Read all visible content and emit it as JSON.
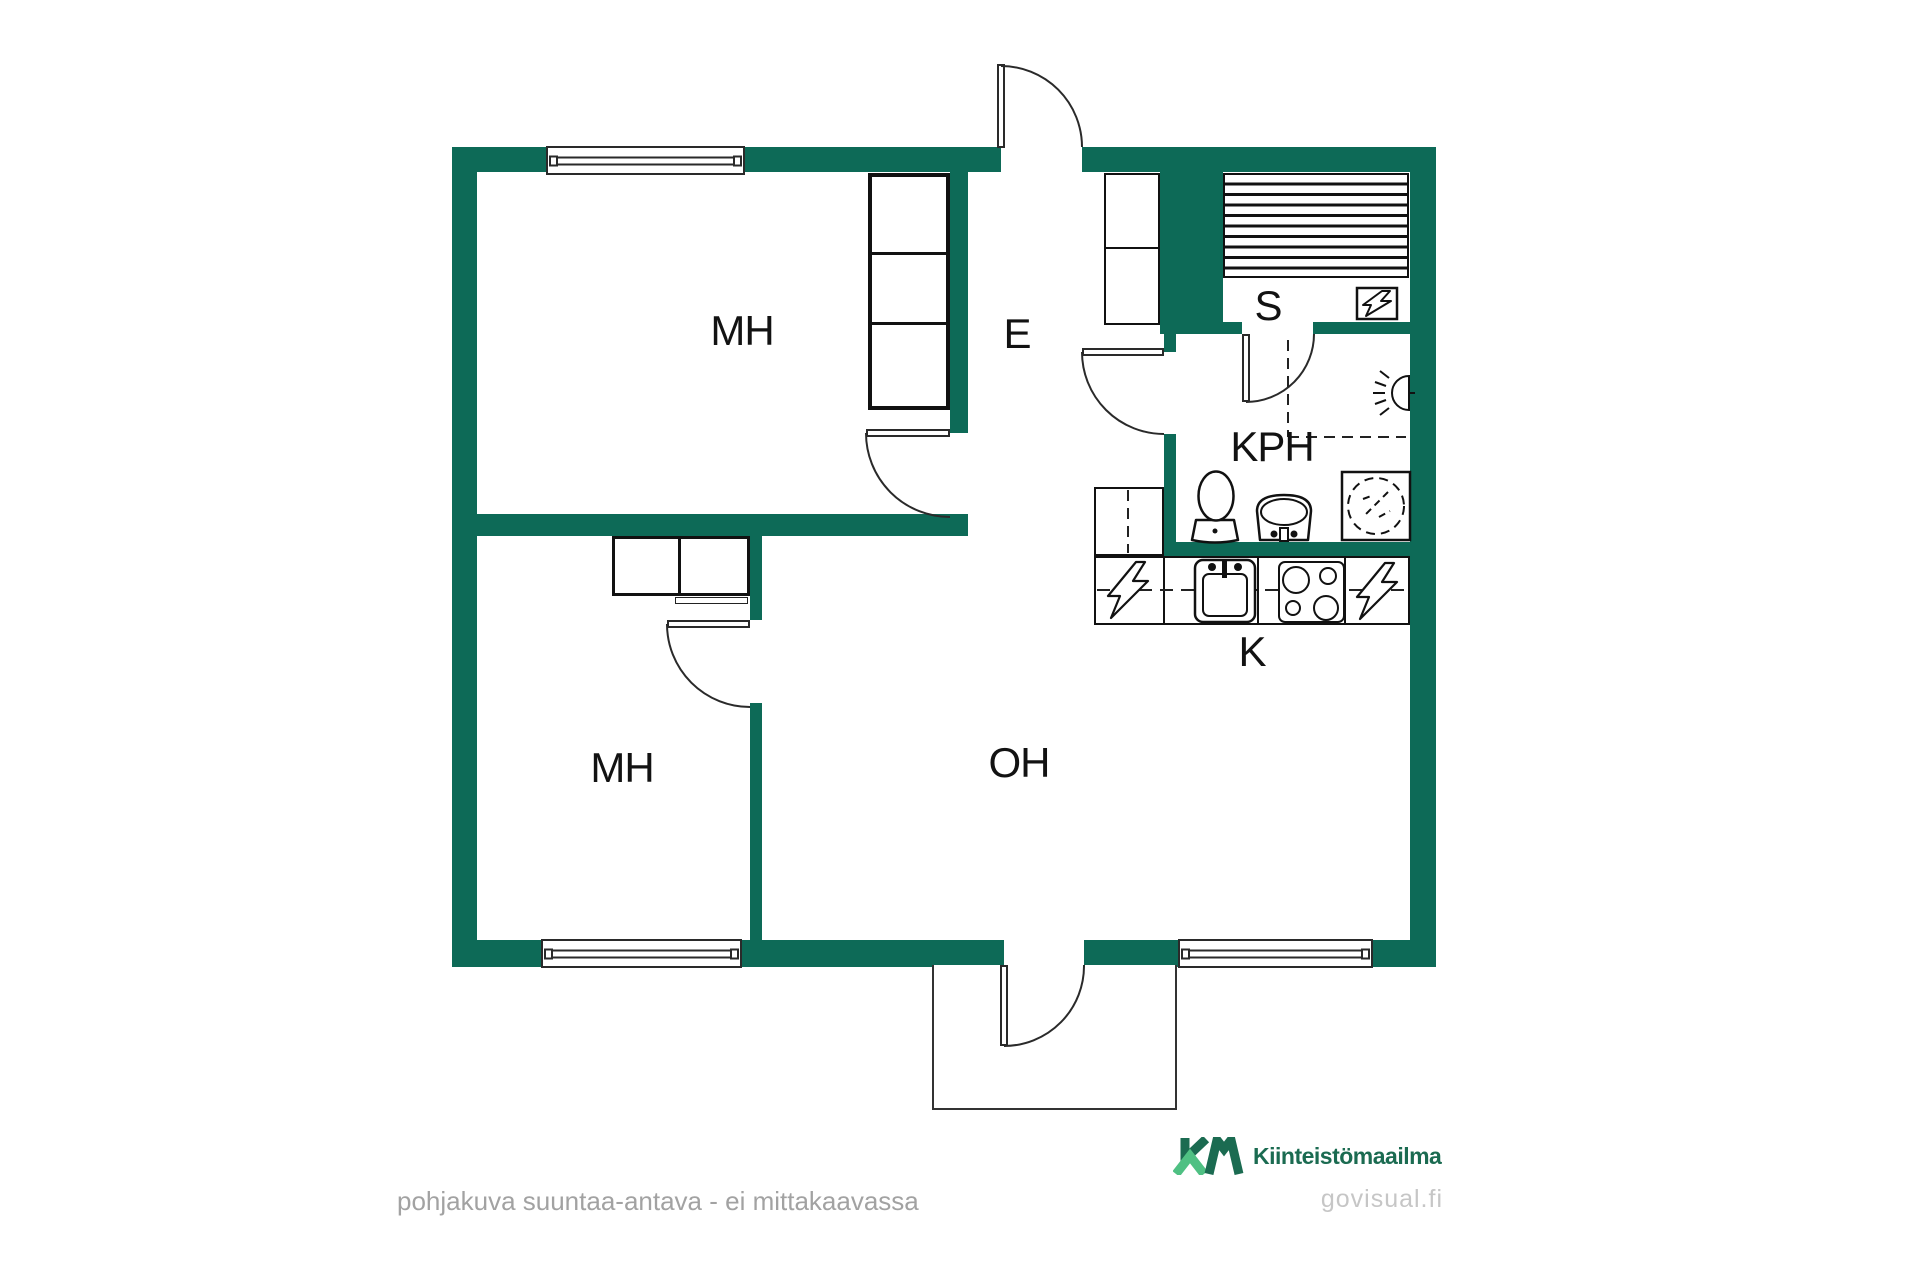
{
  "theme": {
    "wall": "#0D6A57",
    "line": "#1A1A1A",
    "logo_dark": "#1B6B51",
    "logo_light": "#4FC083",
    "disclaimer_gray": "#A2A2A2",
    "watermark_gray": "#C6C6C6"
  },
  "plan": {
    "type": "apartment-floor-plan",
    "rooms": [
      {
        "id": "bedroom-1",
        "label": "MH"
      },
      {
        "id": "entry-hall",
        "label": "E"
      },
      {
        "id": "sauna",
        "label": "S"
      },
      {
        "id": "bathroom",
        "label": "KPH"
      },
      {
        "id": "kitchen",
        "label": "K"
      },
      {
        "id": "bedroom-2",
        "label": "MH"
      },
      {
        "id": "living-room",
        "label": "OH"
      }
    ],
    "fixtures": [
      "window-icon",
      "door-swing-icon",
      "wardrobe-icon",
      "sauna-bench-icon",
      "electric-sauna-heater-icon",
      "lightning-bolt-icon",
      "wall-light-icon",
      "toilet-icon",
      "washbasin-icon",
      "washing-machine-icon",
      "kitchen-sink-icon",
      "stove-icon",
      "balcony-icon"
    ]
  },
  "footer": {
    "disclaimer": "pohjakuva suuntaa-antava - ei mittakaavassa",
    "brand_mark": "KM",
    "brand_name": "Kiinteistömaailma",
    "watermark": "govisual.fi"
  }
}
